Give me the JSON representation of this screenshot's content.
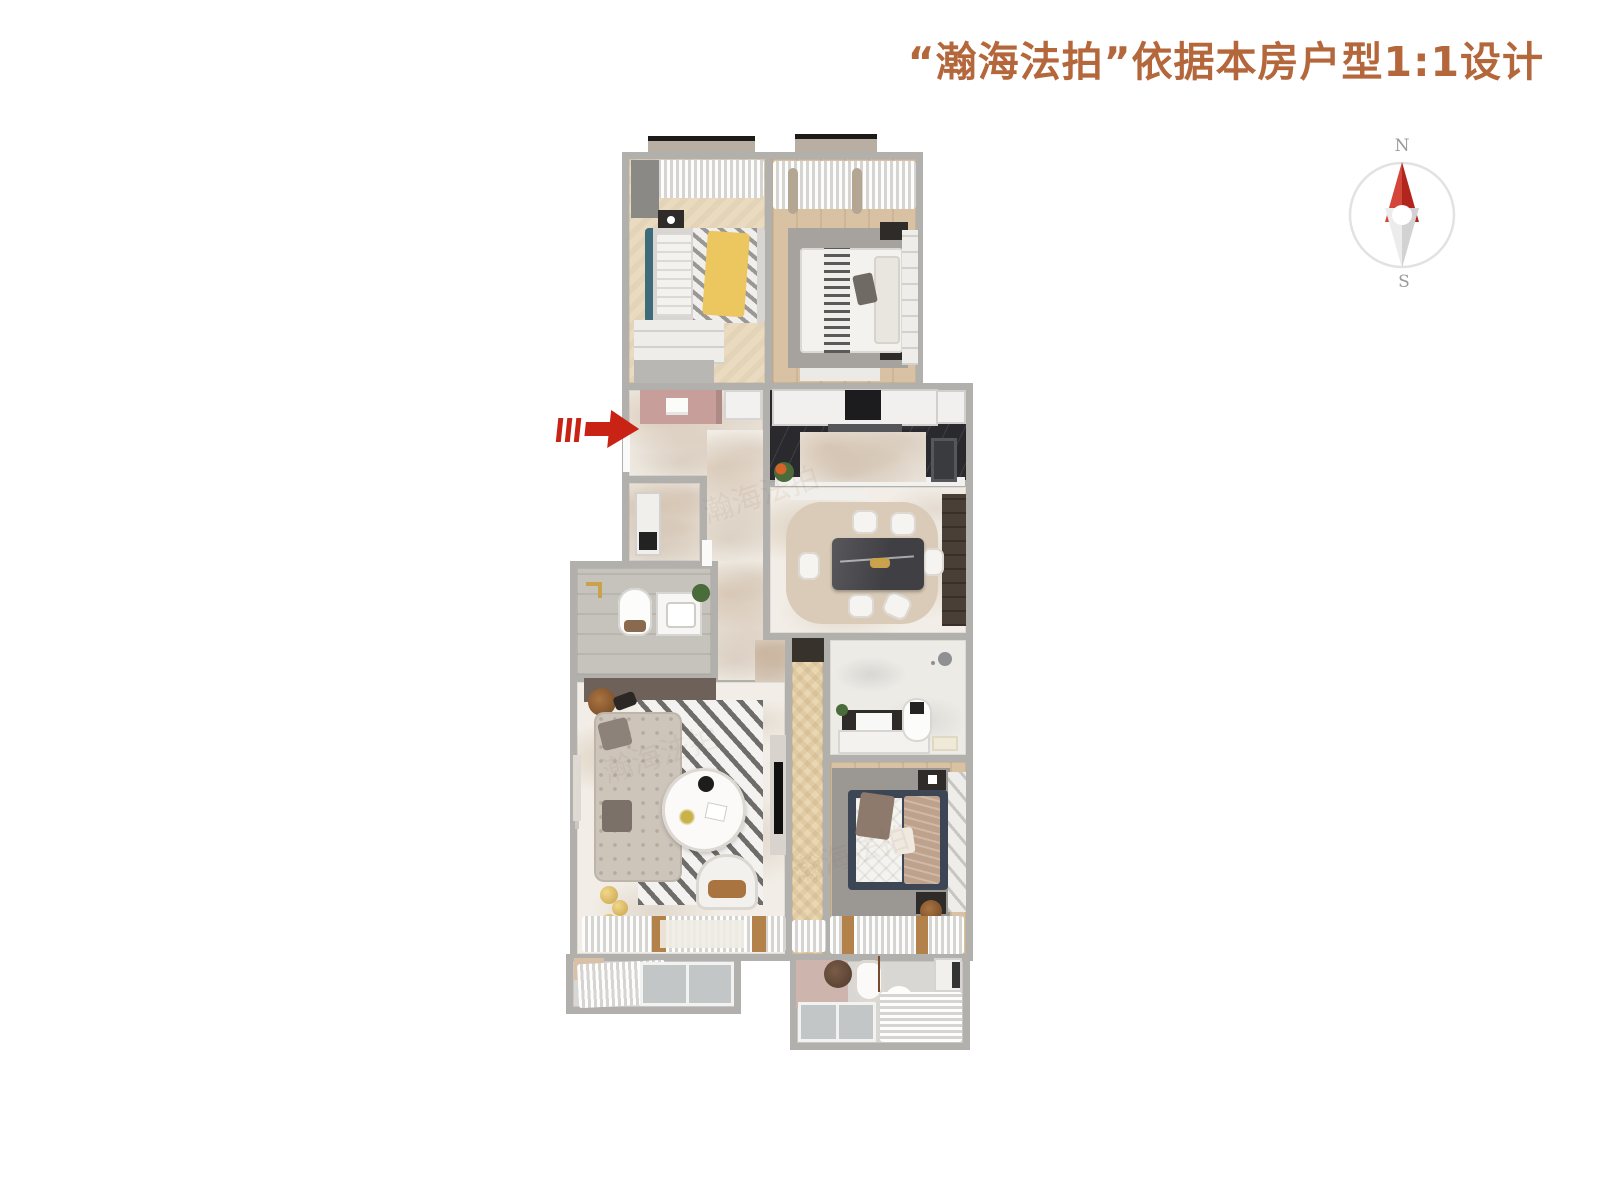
{
  "title": {
    "text": "“瀚海法拍”依据本房户型1:1设计"
  },
  "compass": {
    "north_label": "N",
    "south_label": "S"
  },
  "watermark": {
    "text": "瀚海法拍"
  },
  "icons": {
    "entrance_arrow": "red-right-arrow",
    "compass_needle": "north-red-needle"
  },
  "colors": {
    "title-color": "#b5673c",
    "arrow-red": "#c92315",
    "compass-red": "#d4463a",
    "compass-red-dark": "#b1251c",
    "wall": "#b2b0ad",
    "marble": "#f2eee7",
    "wood-light": "#eadbc0",
    "wood-tan": "#d8c2a3",
    "herringbone": "#e9d6b2",
    "kitchen-black": "#2a292d",
    "tile-gray": "#c6c3bd",
    "rug-gray": "#a6a39e",
    "rug-beige": "#d9cbb8"
  }
}
